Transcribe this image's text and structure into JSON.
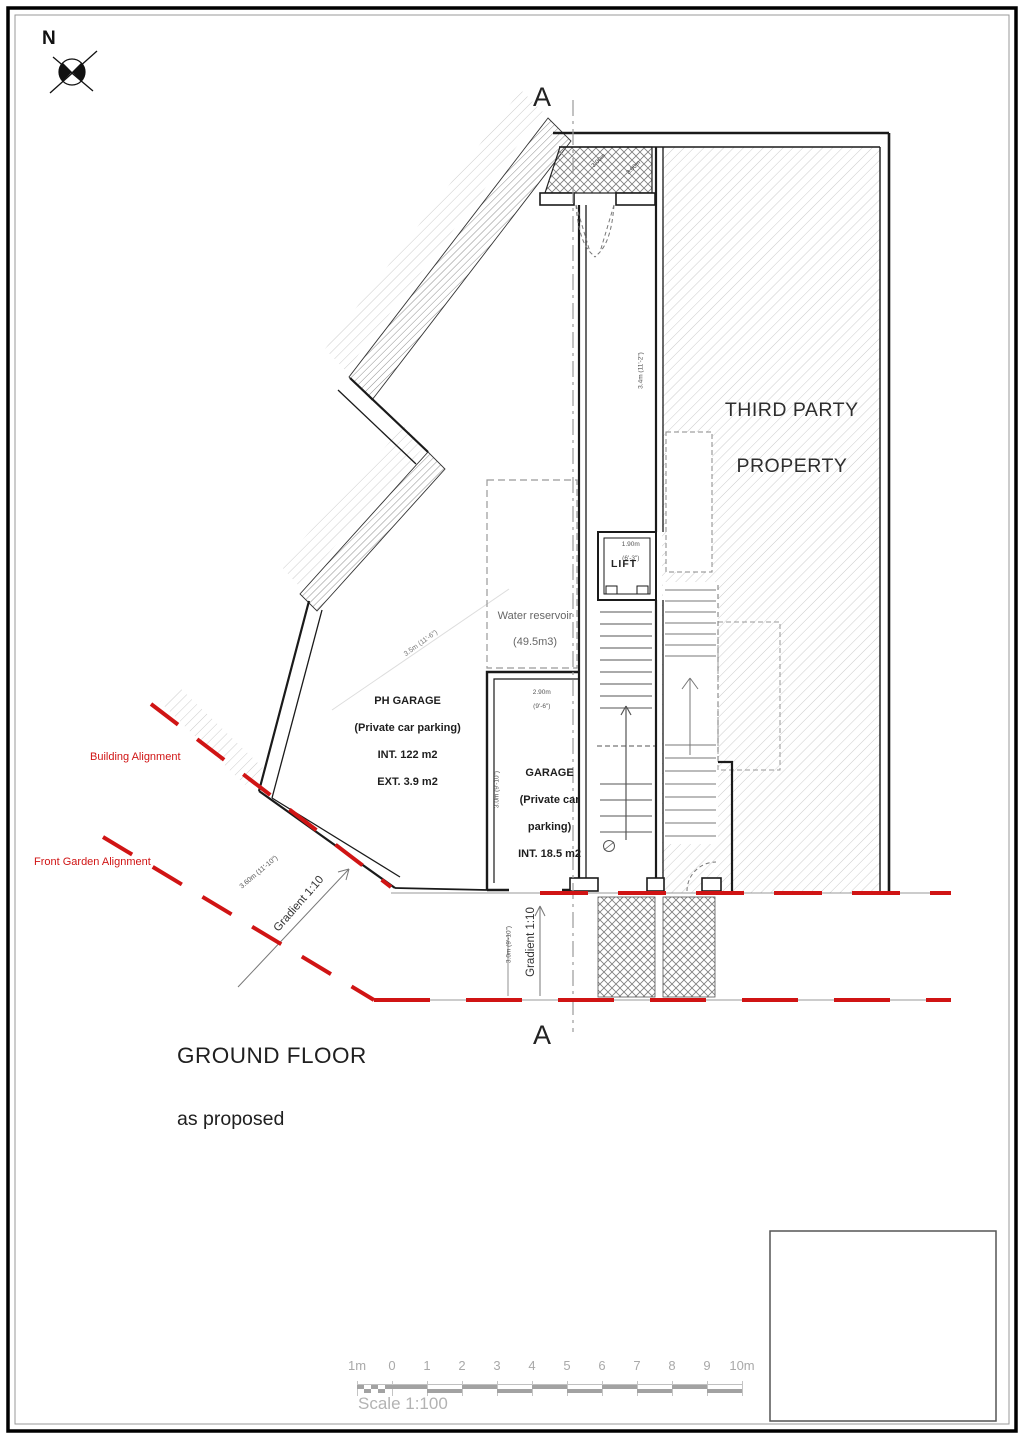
{
  "drawing": {
    "title_line1": "GROUND FLOOR",
    "title_line2": "as proposed",
    "scale_text": "Scale 1:100"
  },
  "compass": {
    "north": "N"
  },
  "section": {
    "top": "A",
    "bottom": "A"
  },
  "areas": {
    "third_party_line1": "THIRD PARTY",
    "third_party_line2": "PROPERTY",
    "water_line1": "Water reservoir",
    "water_line2": "(49.5m3)",
    "ph_garage_line1": "PH GARAGE",
    "ph_garage_line2": "(Private car parking)",
    "ph_garage_line3": "INT. 122 m2",
    "ph_garage_line4": "EXT. 3.9 m2",
    "garage_line1": "GARAGE",
    "garage_line2": "(Private car",
    "garage_line3": "parking)",
    "garage_line4": "INT. 18.5 m2",
    "lift": "LIFT"
  },
  "alignments": {
    "building": "Building Alignment",
    "front_garden": "Front Garden Alignment",
    "gradient_left": "Gradient 1:10",
    "gradient_right": "Gradient 1:10"
  },
  "dimensions": {
    "entrance_a": "3.00m",
    "entrance_b": "3.00m",
    "corridor": "3.4m (11'-2\")",
    "ph_diag": "3.5m (11'-6\")",
    "lift_m": "1.90m",
    "lift_ft": "(6'-3\")",
    "garage_w_m": "2.90m",
    "garage_w_ft": "(9'-6\")",
    "garage_h": "3.0m (9'-10\")",
    "ramp": "3.0m (9'-10\")",
    "building_edge": "3.60m (11'-10\")"
  },
  "scalebar": {
    "ticks": [
      "1m",
      "0",
      "1",
      "2",
      "3",
      "4",
      "5",
      "6",
      "7",
      "8",
      "9",
      "10m"
    ]
  },
  "colors": {
    "alignment_red": "#d01414",
    "wall_black": "#1a1a1a",
    "hatch_gray": "#c8c8c8",
    "dim_gray": "#555555",
    "scale_gray": "#a9a9a9"
  }
}
